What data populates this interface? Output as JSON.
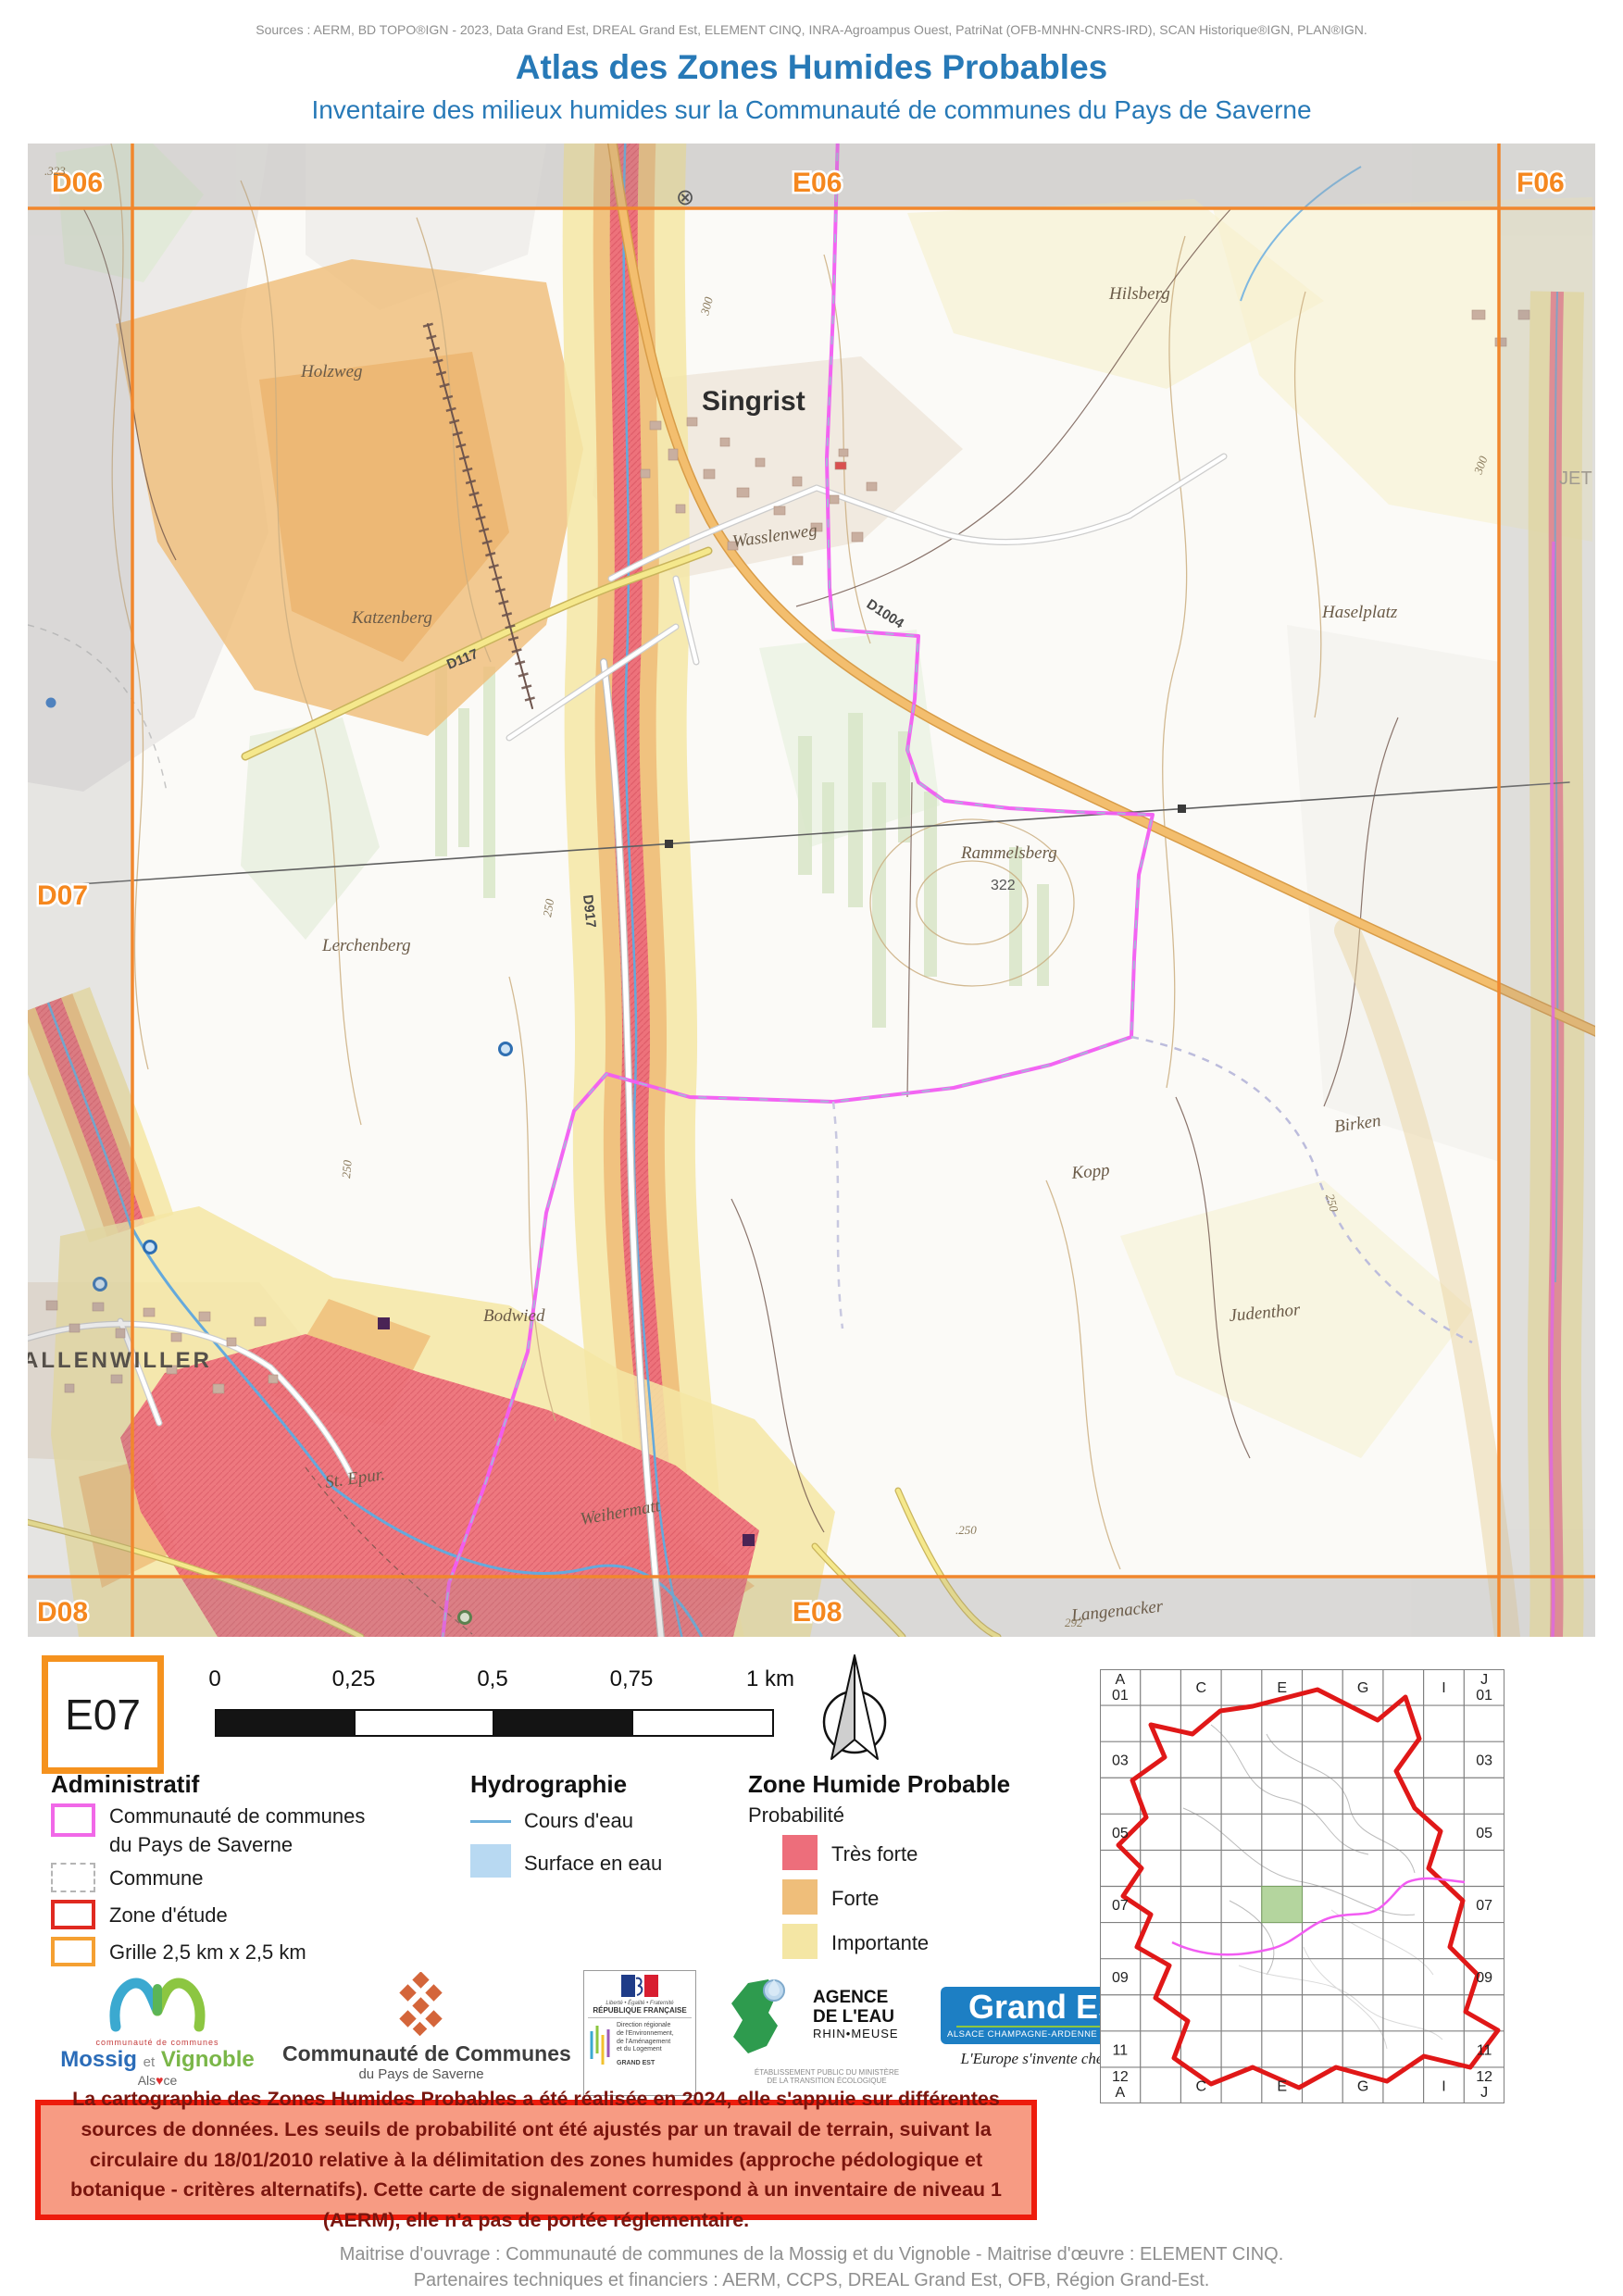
{
  "header": {
    "sources": "Sources : AERM, BD TOPO®IGN - 2023, Data Grand Est, DREAL Grand Est, ELEMENT CINQ, INRA-Agroampus Ouest, PatriNat (OFB-MNHN-CNRS-IRD), SCAN Historique®IGN, PLAN®IGN.",
    "title": "Atlas des Zones Humides Probables",
    "subtitle": "Inventaire des milieux humides sur la Communauté de communes du Pays de Saverne"
  },
  "map": {
    "grid_labels": {
      "d06": "D06",
      "e06": "E06",
      "f06": "F06",
      "d07": "D07",
      "d08": "D08",
      "e08": "E08"
    },
    "labels": {
      "holzweg": "Holzweg",
      "singrist": "Singrist",
      "katzenberg": "Katzenberg",
      "wasslenweg": "Wasslenweg",
      "hilsberg": "Hilsberg",
      "haselplatz": "Haselplatz",
      "rammelsberg": "Rammelsberg",
      "rammelsberg_elev": "322",
      "lerchenberg": "Lerchenberg",
      "birken": "Birken",
      "kopp": "Kopp",
      "judenthor": "Judenthor",
      "bodwied": "Bodwied",
      "allenwiller": "ALLENWILLER",
      "st_epur": "St. Epur.",
      "weihermatt": "Weihermatt",
      "langenacker": "Langenacker",
      "jet": "JET",
      "symbol": "⊗"
    },
    "roads": {
      "d117": "D117",
      "d1004": "D1004",
      "d917": "D917"
    },
    "contours": {
      "c323": ".323",
      "c300a": "300",
      "c300b": "300",
      "c250a": "250",
      "c250b": "250",
      "c250c": "250",
      "c250d": ".250",
      "c292": "292"
    }
  },
  "map_tools": {
    "grid_ref": "E07",
    "scale_ticks": [
      "0",
      "0,25",
      "0,5",
      "0,75",
      "1 km"
    ]
  },
  "legend": {
    "admin_title": "Administratif",
    "cc_line1": "Communauté de communes",
    "cc_line2": "du Pays de Saverne",
    "commune": "Commune",
    "zone_etude": "Zone d'étude",
    "grille": "Grille 2,5 km x 2,5 km",
    "hydro_title": "Hydrographie",
    "cours_eau": "Cours d'eau",
    "surface_eau": "Surface en eau",
    "zhp_title": "Zone Humide Probable",
    "probabilite": "Probabilité",
    "tres_forte": "Très forte",
    "forte": "Forte",
    "importante": "Importante"
  },
  "colors": {
    "tres_forte": "#ED6E7B",
    "forte": "#EFBE7A",
    "importante": "#F4E6A4",
    "cc_boundary": "#F25CF2",
    "zone_etude": "#E01818",
    "grille": "#F5921E",
    "cours_eau": "#64A9DC",
    "surface_eau": "#B8D9F2",
    "title_blue": "#2779B7"
  },
  "logos": {
    "mossig": {
      "cc": "communauté de communes",
      "name1": "Mossig",
      "et": "et",
      "name2": "Vignoble",
      "als": "Als",
      "ce": "ce",
      "heart": "♥"
    },
    "ccps": {
      "line1": "Communauté de Communes",
      "line2": "du Pays de Saverne"
    },
    "dreal": {
      "motto": "Liberté • Égalité • Fraternité",
      "republique": "RÉPUBLIQUE FRANÇAISE",
      "dir1": "Direction régionale",
      "dir2": "de l'Environnement,",
      "dir3": "de l'Aménagement",
      "dir4": "et du Logement",
      "region": "GRAND EST"
    },
    "aerm": {
      "line1": "AGENCE",
      "line2": "DE L'EAU",
      "line3": "RHIN•MEUSE",
      "sub1": "ÉTABLISSEMENT PUBLIC DU MINISTÈRE",
      "sub2": "DE LA TRANSITION ÉCOLOGIQUE"
    },
    "grandest": {
      "name": "Grand Est",
      "sub": "ALSACE CHAMPAGNE-ARDENNE LORRAINE",
      "tagline": "L'Europe s'invente chez nous"
    },
    "e5": {
      "digits": "1234",
      "five": "5",
      "name1": "élément",
      "name2": "cinq"
    }
  },
  "warning": {
    "text": "La cartographie des Zones Humides Probables a été réalisée en 2024, elle s'appuie sur différentes sources de données. Les seuils de probabilité ont été ajustés par un travail de terrain, suivant la circulaire du 18/01/2010 relative à la délimitation des zones humides (approche pédologique et botanique - critères alternatifs). Cette carte de signalement correspond à un inventaire de niveau 1 (AERM), elle n'a pas de portée réglementaire."
  },
  "overview": {
    "corner_tl": [
      "A",
      "01"
    ],
    "corner_tr": [
      "J",
      "01"
    ],
    "corner_bl": [
      "12",
      "A"
    ],
    "corner_br": [
      "12",
      "J"
    ],
    "col_labels": [
      "C",
      "E",
      "G",
      "I"
    ],
    "row_labels": [
      "03",
      "05",
      "07",
      "09",
      "11"
    ]
  },
  "footer": {
    "line1": "Maitrise d'ouvrage : Communauté de communes de la Mossig et du Vignoble - Maitrise d'œuvre : ELEMENT CINQ.",
    "line2": "Partenaires techniques et financiers : AERM, CCPS, DREAL Grand Est, OFB, Région Grand-Est."
  }
}
